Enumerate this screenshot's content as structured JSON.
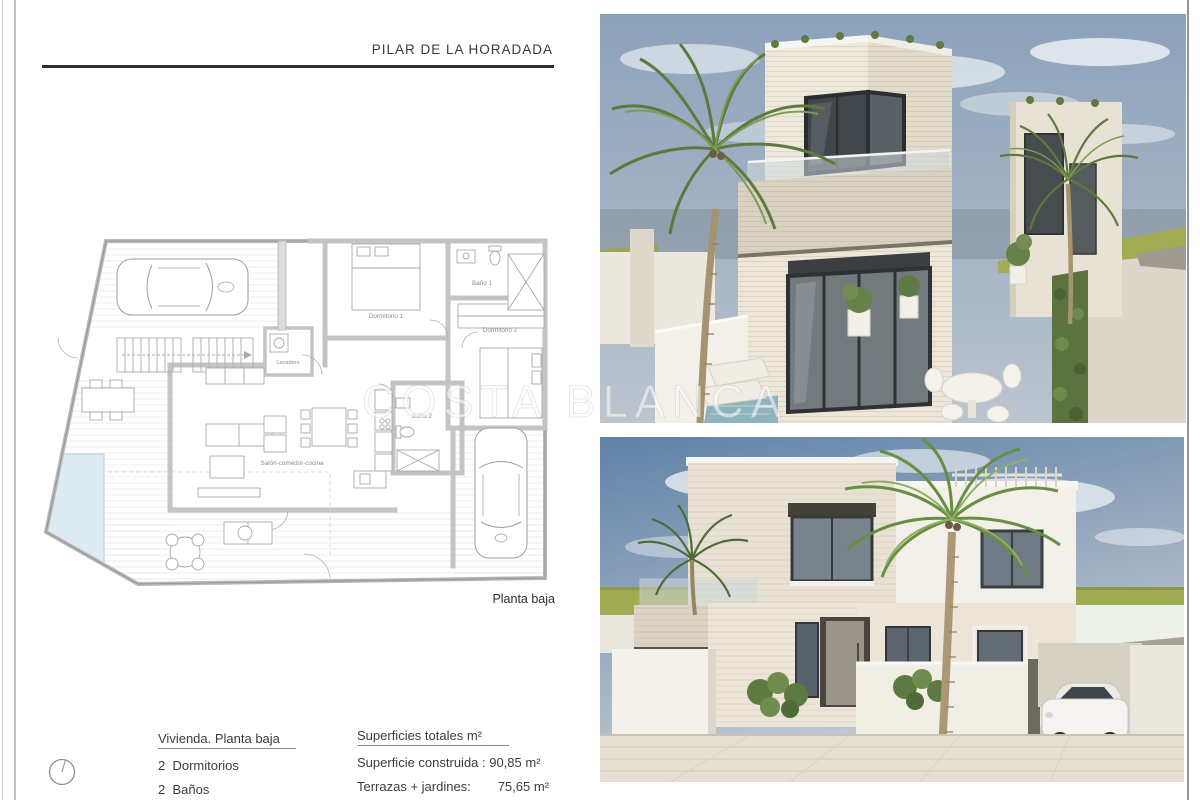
{
  "page": {
    "title": "PILAR DE LA HORADADA",
    "watermark": "COSTA BLANCA"
  },
  "floor_plan": {
    "caption": "Planta baja",
    "rooms": {
      "bedroom1": "Dormitorio 1",
      "bath1": "Baño 1",
      "bedroom2": "Dormitorio 2",
      "laundry": "Lavadero",
      "bath2": "Baño 2",
      "living": "Salón-comedor-cocina"
    }
  },
  "summary": {
    "dwelling_heading": "Vivienda. Planta baja",
    "bedrooms": "2  Dormitorios",
    "bathrooms": "2  Baños",
    "areas_heading": "Superficies totales m²",
    "built_area": "Superficie construida : 90,85 m²",
    "terrace_label": "Terrazas + jardines:",
    "terrace_value": "75,65 m²"
  },
  "colors": {
    "pool": "#ddecf3",
    "grass": "#a2ac55",
    "sky": "#8ca2bb",
    "rule": "#2e2e2e"
  }
}
